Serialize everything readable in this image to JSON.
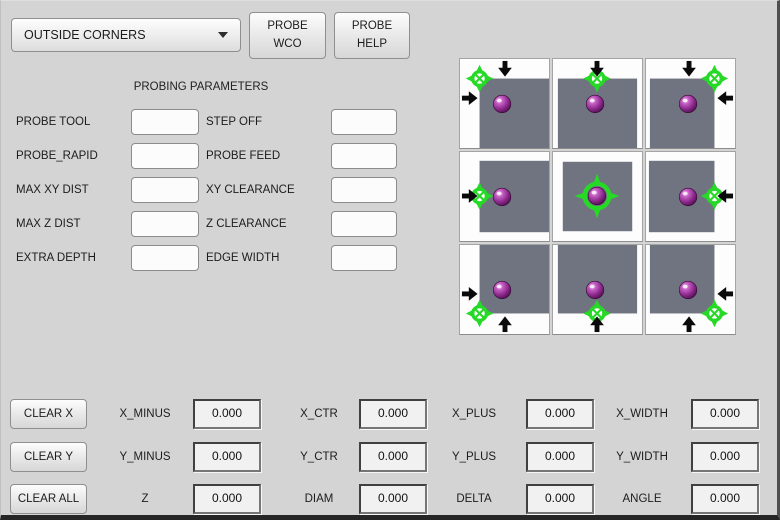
{
  "header": {
    "mode_dropdown": {
      "selected": "OUTSIDE CORNERS"
    },
    "probe_wco_label": "PROBE\nWCO",
    "probe_help_label": "PROBE\nHELP"
  },
  "parameters": {
    "title": "PROBING PARAMETERS",
    "left": [
      {
        "label": "PROBE TOOL",
        "value": ""
      },
      {
        "label": "PROBE_RAPID",
        "value": ""
      },
      {
        "label": "MAX XY DIST",
        "value": ""
      },
      {
        "label": "MAX Z DIST",
        "value": ""
      },
      {
        "label": "EXTRA DEPTH",
        "value": ""
      }
    ],
    "right": [
      {
        "label": "STEP OFF",
        "value": ""
      },
      {
        "label": "PROBE FEED",
        "value": ""
      },
      {
        "label": "XY CLEARANCE",
        "value": ""
      },
      {
        "label": "Z CLEARANCE",
        "value": ""
      },
      {
        "label": "EDGE WIDTH",
        "value": ""
      }
    ]
  },
  "probe_grid": {
    "cells": [
      {
        "name": "probe-outside-corner-top-left-button",
        "crosshair": "top-left",
        "arrows": [
          "down",
          "right"
        ]
      },
      {
        "name": "probe-outside-edge-top-button",
        "crosshair": "top",
        "arrows": [
          "down"
        ]
      },
      {
        "name": "probe-outside-corner-top-right-button",
        "crosshair": "top-right",
        "arrows": [
          "down",
          "left"
        ]
      },
      {
        "name": "probe-outside-edge-left-button",
        "crosshair": "left",
        "arrows": [
          "right"
        ]
      },
      {
        "name": "probe-center-button",
        "crosshair": "center",
        "arrows": []
      },
      {
        "name": "probe-outside-edge-right-button",
        "crosshair": "right",
        "arrows": [
          "left"
        ]
      },
      {
        "name": "probe-outside-corner-bottom-left-button",
        "crosshair": "bottom-left",
        "arrows": [
          "right",
          "up"
        ]
      },
      {
        "name": "probe-outside-edge-bottom-button",
        "crosshair": "bottom",
        "arrows": [
          "up"
        ]
      },
      {
        "name": "probe-outside-corner-bottom-right-button",
        "crosshair": "bottom-right",
        "arrows": [
          "left",
          "up"
        ]
      }
    ],
    "colors": {
      "part_gray": "#6f7480",
      "crosshair_green": "#26d926",
      "sphere_purple": "#8e2a8e",
      "arrow_black": "#0a0a0a"
    }
  },
  "results": {
    "clear_buttons": [
      {
        "label": "CLEAR X"
      },
      {
        "label": "CLEAR Y"
      },
      {
        "label": "CLEAR ALL"
      }
    ],
    "rows": [
      {
        "cells": [
          {
            "label": "X_MINUS",
            "value": "0.000"
          },
          {
            "label": "X_CTR",
            "value": "0.000"
          },
          {
            "label": "X_PLUS",
            "value": "0.000"
          },
          {
            "label": "X_WIDTH",
            "value": "0.000"
          }
        ]
      },
      {
        "cells": [
          {
            "label": "Y_MINUS",
            "value": "0.000"
          },
          {
            "label": "Y_CTR",
            "value": "0.000"
          },
          {
            "label": "Y_PLUS",
            "value": "0.000"
          },
          {
            "label": "Y_WIDTH",
            "value": "0.000"
          }
        ]
      },
      {
        "cells": [
          {
            "label": "Z",
            "value": "0.000"
          },
          {
            "label": "DIAM",
            "value": "0.000"
          },
          {
            "label": "DELTA",
            "value": "0.000"
          },
          {
            "label": "ANGLE",
            "value": "0.000"
          }
        ]
      }
    ]
  }
}
